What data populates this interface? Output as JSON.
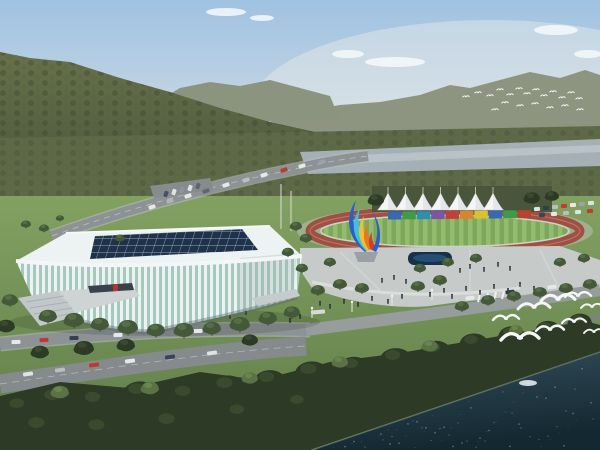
{
  "scene": {
    "description": "Aerial architectural rendering: white ribbed sports stadium with dark glass roof beside an athletic track with white canopy tents and a rainbow grandstand wall, plaza with colorful flame sculpture, forested mountains behind, river band, dark tree shoreline and teal water with flying white gulls",
    "palette": {
      "sky_top": "#9fc2e2",
      "sky_mid": "#c6d6e2",
      "sky_horizon": "#e4e9ea",
      "ridge_far": "#a9b1a4",
      "ridge_near": "#8d9580",
      "hill_top": "#68714a",
      "hill_bottom": "#49543b",
      "forest_band": "#5e6a47",
      "river": "#a5b0b6",
      "river_light": "#c2cacd",
      "lawn_top": "#82a161",
      "lawn_bottom": "#5f7d49",
      "road": "#8d9395",
      "road_light": "#b6bbbc",
      "plaza": "#c6cac9",
      "track_red": "#9e5143",
      "field_green_a": "#7ea75b",
      "field_green_b": "#93bc6d",
      "tent_white": "#f4f6f6",
      "stadium_white": "#edf2f2",
      "stadium_glass": "#a7c8bc",
      "roof_glass": "#20314a",
      "roof_mullion": "#8fb0c2",
      "water_top": "#35505e",
      "water_bottom": "#142831",
      "shore_trees": "#2c3a26",
      "bird_white": "#f5f7f7",
      "people_dark": "#262b31",
      "fountain_dark": "#16324a",
      "sculpture_blue": "#2b5fc7",
      "sculpture_cyan": "#3fc0e0",
      "sculpture_yellow": "#f0c030",
      "sculpture_orange": "#e87820",
      "sculpture_red": "#d04028",
      "canopy_dark": "#39424a",
      "accent_red": "#b5352e"
    },
    "clouds": [
      [
        395,
        62,
        30,
        5
      ],
      [
        348,
        54,
        16,
        4
      ],
      [
        556,
        30,
        22,
        5
      ],
      [
        588,
        54,
        14,
        4
      ],
      [
        226,
        12,
        20,
        4
      ],
      [
        262,
        18,
        12,
        3
      ]
    ],
    "distant_flock": [
      [
        466,
        97
      ],
      [
        478,
        93
      ],
      [
        490,
        96
      ],
      [
        500,
        90
      ],
      [
        510,
        95
      ],
      [
        519,
        89
      ],
      [
        527,
        94
      ],
      [
        536,
        90
      ],
      [
        544,
        96
      ],
      [
        553,
        92
      ],
      [
        562,
        98
      ],
      [
        571,
        93
      ],
      [
        579,
        99
      ],
      [
        505,
        103
      ],
      [
        520,
        106
      ],
      [
        535,
        104
      ],
      [
        550,
        108
      ],
      [
        565,
        106
      ],
      [
        580,
        110
      ],
      [
        495,
        110
      ]
    ],
    "birds_large": [
      [
        506,
        320,
        13
      ],
      [
        534,
        309,
        16
      ],
      [
        558,
        301,
        17
      ],
      [
        578,
        297,
        13
      ],
      [
        592,
        308,
        11
      ],
      [
        520,
        340,
        19
      ],
      [
        550,
        331,
        14
      ],
      [
        574,
        323,
        12
      ],
      [
        594,
        333,
        10
      ]
    ],
    "tents": {
      "count": 7,
      "x_start": 388,
      "spacing": 17.5,
      "peak_y": 193,
      "base_y": 210,
      "width": 21
    },
    "stand_wall": {
      "x_start": 388,
      "y": 211.5,
      "seg_w": 14.4,
      "seg_h": 8,
      "colors": [
        "#3a67b5",
        "#3e9b49",
        "#2f8fae",
        "#7c55a8",
        "#c23f3a",
        "#d9822f",
        "#d9c232",
        "#3a67b5",
        "#3e9b49",
        "#b5432f"
      ]
    },
    "vehicles": [
      [
        16,
        342,
        "#e6e8e9",
        9,
        -3
      ],
      [
        44,
        340,
        "#c0392f",
        9,
        -3
      ],
      [
        74,
        338,
        "#33414f",
        9,
        -3
      ],
      [
        118,
        335,
        "#e6e8e9",
        9,
        -3
      ],
      [
        158,
        333,
        "#8d959b",
        9,
        -3
      ],
      [
        198,
        331,
        "#e6e8e9",
        9,
        -3
      ],
      [
        28,
        374,
        "#dfe3e4",
        10,
        -8
      ],
      [
        60,
        370,
        "#b8bfc2",
        10,
        -8
      ],
      [
        94,
        365,
        "#c0392f",
        10,
        -8
      ],
      [
        130,
        361,
        "#e6e8e9",
        10,
        -8
      ],
      [
        170,
        357,
        "#36455c",
        10,
        -8
      ],
      [
        212,
        353,
        "#dfe3e4",
        10,
        -8
      ],
      [
        152,
        207,
        "#e6e8e9",
        7,
        -18
      ],
      [
        170,
        201,
        "#aeb5ba",
        7,
        -18
      ],
      [
        188,
        196,
        "#e6e8e9",
        7,
        -18
      ],
      [
        206,
        191,
        "#5d676f",
        7,
        -18
      ],
      [
        226,
        185,
        "#e6e8e9",
        7,
        -18
      ],
      [
        246,
        180,
        "#b8bfc2",
        7,
        -18
      ],
      [
        264,
        175,
        "#e6e8e9",
        7,
        -18
      ],
      [
        284,
        170,
        "#c0392f",
        7,
        -18
      ],
      [
        302,
        166,
        "#e6e8e9",
        7,
        -18
      ],
      [
        322,
        162,
        "#9aa3a8",
        7,
        -18
      ],
      [
        166,
        194,
        "#42506a",
        6,
        -70
      ],
      [
        174,
        192,
        "#dfe3e4",
        6,
        -70
      ],
      [
        182,
        190,
        "#8d959b",
        6,
        -70
      ],
      [
        190,
        188,
        "#dfe3e4",
        6,
        -70
      ],
      [
        198,
        186,
        "#5d676f",
        6,
        -70
      ],
      [
        470,
        298,
        "#e6e8e9",
        9,
        -7
      ],
      [
        510,
        292,
        "#2e3d52",
        9,
        -7
      ],
      [
        552,
        287,
        "#e6e8e9",
        9,
        -7
      ],
      [
        318,
        312,
        "#d6dadb",
        14,
        -5
      ],
      [
        537,
        209,
        "#dfe3e5",
        6,
        -5
      ],
      [
        546,
        208,
        "#2e3d52",
        6,
        -5
      ],
      [
        555,
        207,
        "#b8bec2",
        6,
        -5
      ],
      [
        564,
        206,
        "#c23b32",
        6,
        -5
      ],
      [
        573,
        205,
        "#e8eaea",
        6,
        -5
      ],
      [
        582,
        204,
        "#9aa3a8",
        6,
        -5
      ],
      [
        591,
        203,
        "#dfe3e5",
        6,
        -5
      ],
      [
        542,
        215,
        "#36455c",
        6,
        -5
      ],
      [
        554,
        214,
        "#e8eaea",
        6,
        -5
      ],
      [
        566,
        213,
        "#b8bec2",
        6,
        -5
      ],
      [
        578,
        212,
        "#dfe3e5",
        6,
        -5
      ],
      [
        590,
        211,
        "#c23b32",
        6,
        -5
      ]
    ],
    "people": [
      [
        320,
        305
      ],
      [
        330,
        308
      ],
      [
        344,
        303
      ],
      [
        358,
        306
      ],
      [
        372,
        300
      ],
      [
        388,
        303
      ],
      [
        402,
        298
      ],
      [
        300,
        318
      ],
      [
        290,
        322
      ],
      [
        270,
        320
      ],
      [
        430,
        296
      ],
      [
        444,
        292
      ],
      [
        452,
        298
      ],
      [
        466,
        290
      ],
      [
        480,
        294
      ],
      [
        494,
        288
      ],
      [
        508,
        292
      ],
      [
        520,
        286
      ],
      [
        534,
        290
      ],
      [
        460,
        272
      ],
      [
        470,
        268
      ],
      [
        484,
        271
      ],
      [
        498,
        266
      ],
      [
        510,
        270
      ],
      [
        382,
        282
      ],
      [
        394,
        279
      ],
      [
        406,
        283
      ],
      [
        72,
        306
      ],
      [
        84,
        309
      ],
      [
        96,
        304
      ],
      [
        108,
        307
      ],
      [
        120,
        302
      ],
      [
        230,
        318
      ],
      [
        246,
        314
      ]
    ],
    "trees": [
      [
        48,
        316,
        9,
        1
      ],
      [
        74,
        320,
        10,
        1
      ],
      [
        100,
        324,
        9,
        1
      ],
      [
        128,
        327,
        10,
        1
      ],
      [
        156,
        330,
        9,
        1
      ],
      [
        184,
        330,
        10,
        1
      ],
      [
        212,
        328,
        9,
        1
      ],
      [
        240,
        324,
        10,
        1
      ],
      [
        268,
        318,
        9,
        1
      ],
      [
        292,
        312,
        8,
        1
      ],
      [
        10,
        300,
        8,
        1
      ],
      [
        6,
        326,
        9,
        0
      ],
      [
        40,
        352,
        9,
        0
      ],
      [
        84,
        348,
        10,
        0
      ],
      [
        126,
        345,
        9,
        0
      ],
      [
        250,
        340,
        8,
        0
      ],
      [
        26,
        224,
        5,
        1
      ],
      [
        44,
        228,
        5,
        1
      ],
      [
        120,
        238,
        5,
        1
      ],
      [
        60,
        218,
        4,
        1
      ],
      [
        318,
        290,
        7,
        1
      ],
      [
        340,
        284,
        7,
        1
      ],
      [
        362,
        288,
        7,
        1
      ],
      [
        302,
        268,
        6,
        1
      ],
      [
        330,
        262,
        6,
        1
      ],
      [
        288,
        252,
        6,
        1
      ],
      [
        418,
        286,
        7,
        1
      ],
      [
        440,
        280,
        7,
        1
      ],
      [
        462,
        306,
        7,
        1
      ],
      [
        488,
        300,
        7,
        1
      ],
      [
        514,
        296,
        7,
        1
      ],
      [
        540,
        292,
        7,
        1
      ],
      [
        566,
        288,
        7,
        1
      ],
      [
        590,
        284,
        7,
        1
      ],
      [
        420,
        268,
        6,
        1
      ],
      [
        448,
        262,
        6,
        1
      ],
      [
        476,
        258,
        6,
        1
      ],
      [
        560,
        262,
        6,
        1
      ],
      [
        584,
        258,
        6,
        1
      ],
      [
        306,
        238,
        6,
        1
      ],
      [
        296,
        226,
        6,
        1
      ],
      [
        376,
        200,
        8,
        0
      ],
      [
        532,
        198,
        8,
        0
      ],
      [
        552,
        196,
        7,
        0
      ],
      [
        20,
        408,
        16,
        0
      ],
      [
        56,
        400,
        18,
        0
      ],
      [
        96,
        402,
        17,
        0
      ],
      [
        140,
        394,
        18,
        0
      ],
      [
        186,
        396,
        17,
        0
      ],
      [
        228,
        388,
        18,
        0
      ],
      [
        270,
        382,
        17,
        0
      ],
      [
        312,
        374,
        18,
        0
      ],
      [
        354,
        368,
        16,
        0
      ],
      [
        396,
        360,
        17,
        0
      ],
      [
        436,
        352,
        16,
        0
      ],
      [
        474,
        344,
        15,
        0
      ],
      [
        512,
        336,
        14,
        0
      ],
      [
        548,
        330,
        13,
        0
      ],
      [
        580,
        322,
        12,
        0
      ],
      [
        40,
        428,
        18,
        0
      ],
      [
        100,
        430,
        18,
        0
      ],
      [
        170,
        424,
        18,
        0
      ],
      [
        240,
        414,
        16,
        0
      ],
      [
        300,
        404,
        15,
        0
      ],
      [
        60,
        392,
        9,
        2
      ],
      [
        150,
        388,
        9,
        2
      ],
      [
        250,
        378,
        8,
        2
      ],
      [
        340,
        362,
        8,
        2
      ],
      [
        430,
        346,
        8,
        2
      ],
      [
        516,
        330,
        7,
        2
      ]
    ],
    "water": {
      "sparkle_count": 90,
      "bright_spot": [
        528,
        383
      ]
    }
  }
}
